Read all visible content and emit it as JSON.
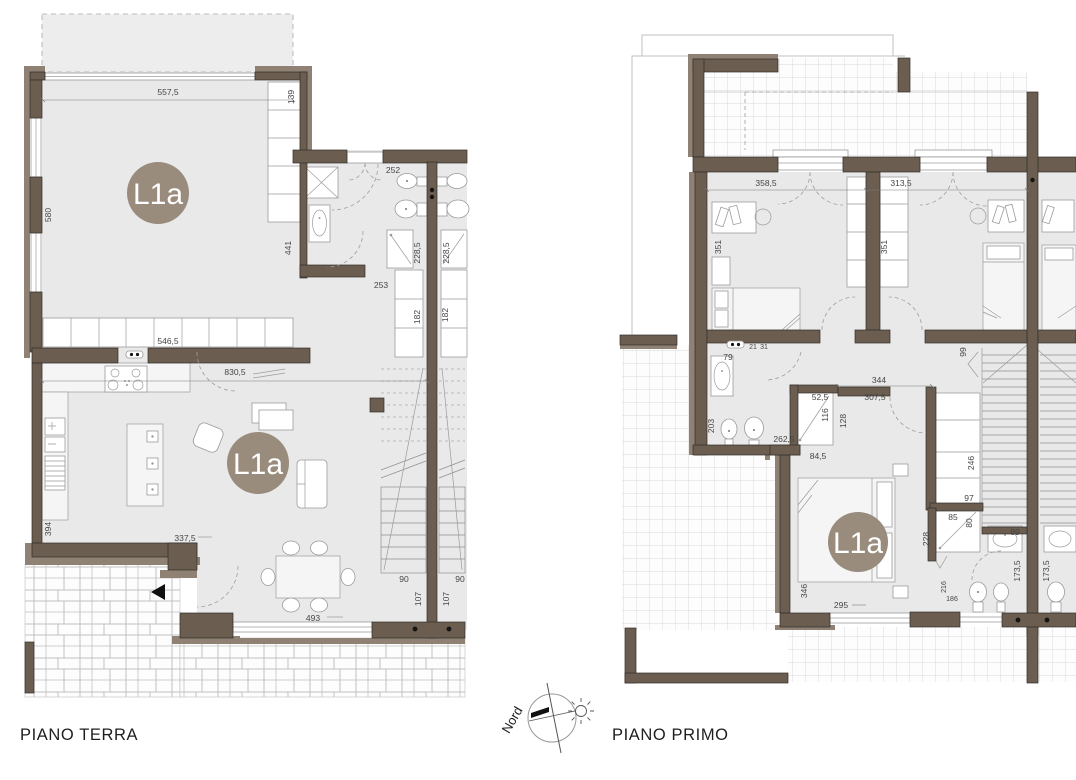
{
  "unit": "L1a",
  "colors": {
    "wall": "#6b5d4f",
    "wall_band": "#8f8274",
    "floor_fill": "#e9e9ea",
    "badge": "#998c7d",
    "dim_text": "#454545",
    "tile_line": "#cdcdcd"
  },
  "ground_floor": {
    "title": "PIANO TERRA",
    "badge1": "L1a",
    "badge2": "L1a",
    "dims": {
      "d5575": "557,5",
      "d139": "139",
      "d580": "580",
      "d441": "441",
      "d252": "252",
      "d2285a": "228,5",
      "d2285b": "228,5",
      "d253": "253",
      "d182a": "182",
      "d182b": "182",
      "d5465": "546,5",
      "d8305": "830,5",
      "d394": "394",
      "d3375": "337,5",
      "d493": "493",
      "d90a": "90",
      "d90b": "90",
      "d107a": "107",
      "d107b": "107"
    }
  },
  "first_floor": {
    "title": "PIANO PRIMO",
    "badge": "L1a",
    "dims": {
      "d3585": "358,5",
      "d3135": "313,5",
      "d351a": "351",
      "d351b": "351",
      "d21": "21",
      "d31": "31",
      "d79": "79",
      "d203": "203",
      "d2625": "262,5",
      "d525": "52,5",
      "d116": "116",
      "d128": "128",
      "d845": "84,5",
      "d344": "344",
      "d3075": "307,5",
      "d99": "99",
      "d246": "246",
      "d97": "97",
      "d85": "85",
      "d80": "80",
      "d89": "89",
      "d228": "228",
      "d216": "216",
      "d186": "186",
      "d1735a": "173,5",
      "d1735b": "173,5",
      "d346": "346",
      "d295": "295"
    }
  },
  "compass": {
    "north_label": "Nord"
  }
}
